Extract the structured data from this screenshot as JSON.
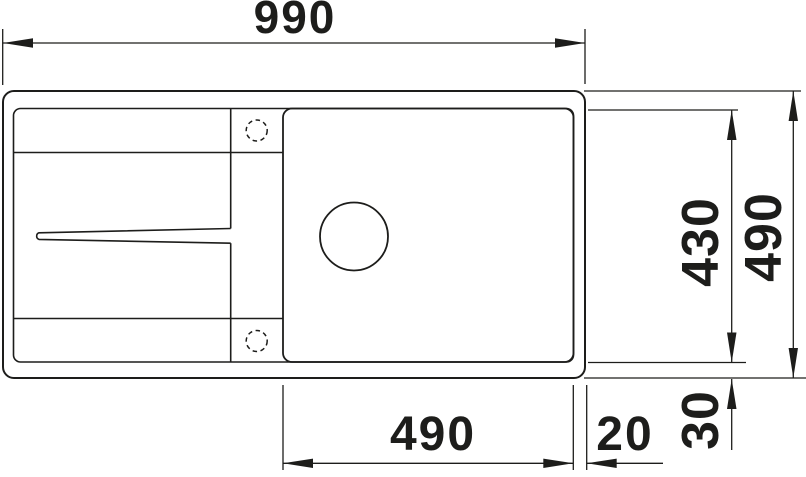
{
  "colors": {
    "background": "#ffffff",
    "line": "#1d1d1b"
  },
  "dimensions": {
    "overall_length": "990",
    "overall_depth": "490",
    "bowl_depth": "430",
    "bowl_length": "490",
    "rim_right": "20",
    "rim_bottom": "30"
  },
  "features": [
    "sink-outline",
    "rim-inner-contour",
    "main-bowl",
    "drain-hole",
    "faucet-hole-top",
    "faucet-hole-bottom",
    "drainboard-divider",
    "drain-groove"
  ]
}
